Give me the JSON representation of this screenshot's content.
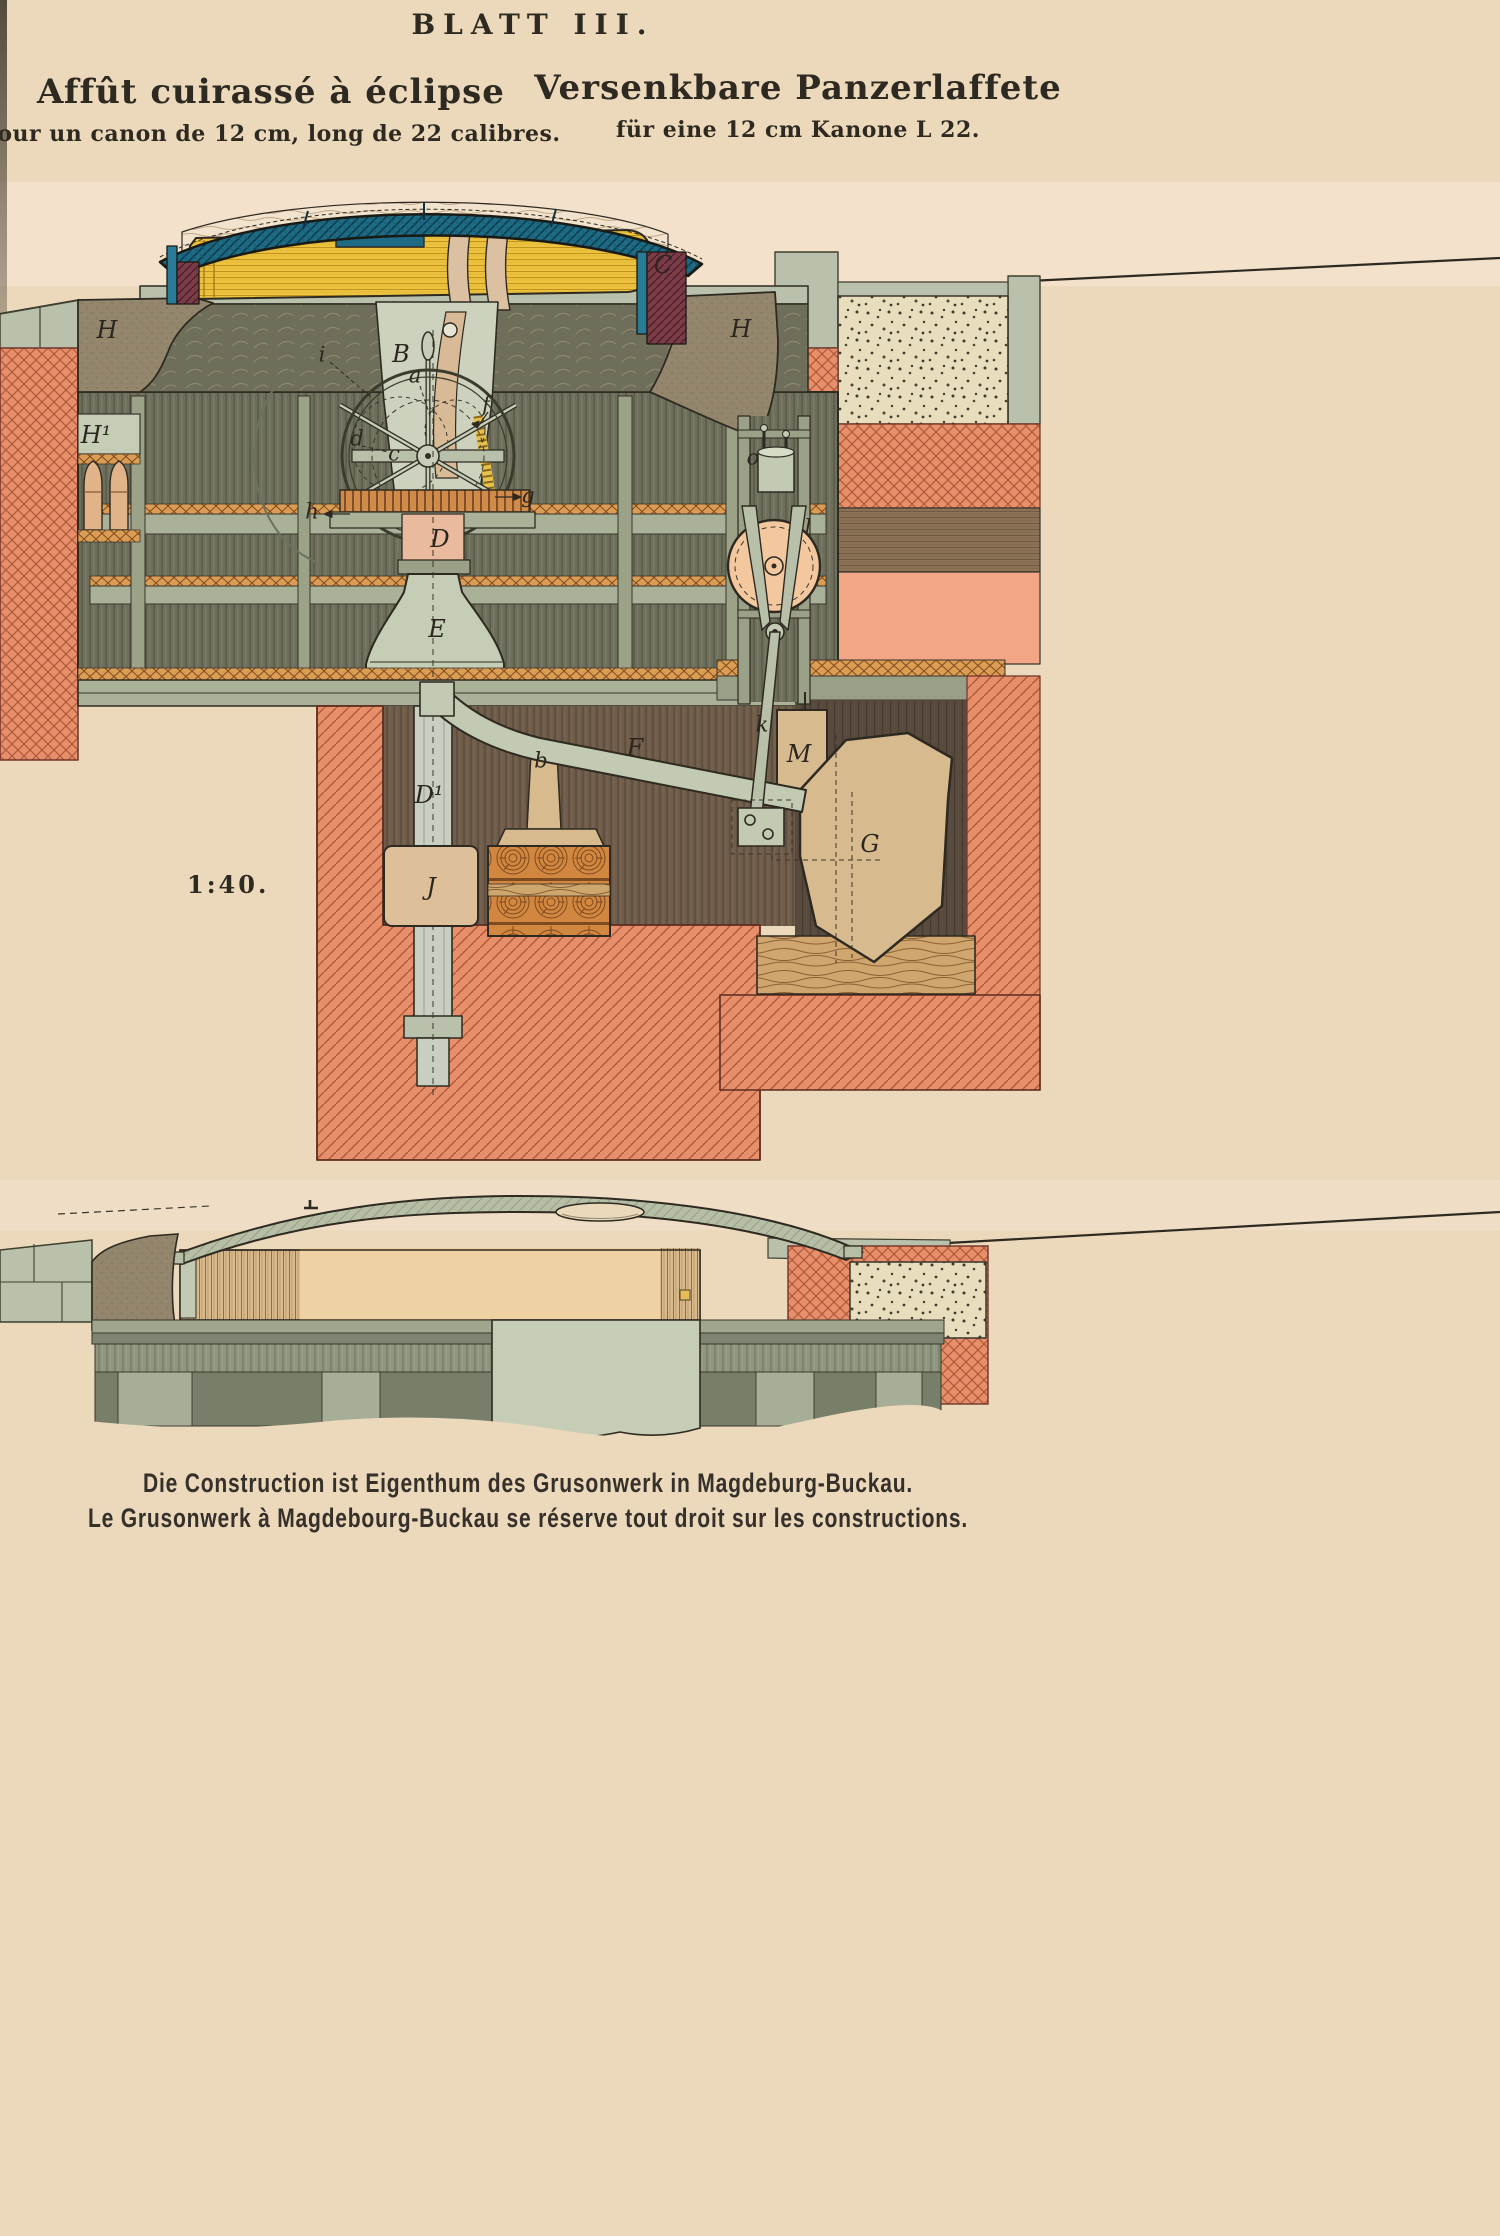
{
  "page": {
    "plate_title": "BLATT III.",
    "title_fr": "Affût cuirassé à éclipse",
    "subtitle_fr": "pour un canon de 12 cm, long de 22 calibres.",
    "title_de": "Versenkbare Panzerlaffete",
    "subtitle_de": "für eine 12 cm Kanone L 22.",
    "scale_label": "1:40.",
    "footer_de": "Die Construction ist Eigenthum des Grusonwerk in Magdeburg-Buckau.",
    "footer_fr": "Le Grusonwerk à Magdebourg-Buckau se réserve tout droit sur les constructions."
  },
  "diagram_labels": [
    {
      "text": "H",
      "x": 107,
      "y": 331,
      "kind": "cap"
    },
    {
      "text": "H¹",
      "x": 96,
      "y": 436,
      "kind": "cap"
    },
    {
      "text": "C",
      "x": 663,
      "y": 266,
      "kind": "cap"
    },
    {
      "text": "B",
      "x": 401,
      "y": 355,
      "kind": "cap"
    },
    {
      "text": "H",
      "x": 741,
      "y": 330,
      "kind": "cap"
    },
    {
      "text": "i",
      "x": 322,
      "y": 356,
      "kind": "low"
    },
    {
      "text": "a",
      "x": 415,
      "y": 377,
      "kind": "low"
    },
    {
      "text": "f",
      "x": 486,
      "y": 406,
      "kind": "low"
    },
    {
      "text": "d",
      "x": 357,
      "y": 440,
      "kind": "low"
    },
    {
      "text": "c",
      "x": 394,
      "y": 455,
      "kind": "low"
    },
    {
      "text": "g",
      "x": 528,
      "y": 497,
      "kind": "low"
    },
    {
      "text": "h",
      "x": 312,
      "y": 513,
      "kind": "low"
    },
    {
      "text": "D",
      "x": 440,
      "y": 540,
      "kind": "cap"
    },
    {
      "text": "E",
      "x": 437,
      "y": 630,
      "kind": "cap"
    },
    {
      "text": "o",
      "x": 753,
      "y": 459,
      "kind": "low"
    },
    {
      "text": "l",
      "x": 808,
      "y": 529,
      "kind": "low"
    },
    {
      "text": "k",
      "x": 762,
      "y": 726,
      "kind": "low"
    },
    {
      "text": "F",
      "x": 635,
      "y": 749,
      "kind": "cap"
    },
    {
      "text": "b",
      "x": 541,
      "y": 762,
      "kind": "low"
    },
    {
      "text": "D¹",
      "x": 429,
      "y": 796,
      "kind": "cap"
    },
    {
      "text": "M",
      "x": 799,
      "y": 755,
      "kind": "cap"
    },
    {
      "text": "G",
      "x": 870,
      "y": 845,
      "kind": "cap"
    },
    {
      "text": "J",
      "x": 431,
      "y": 888,
      "kind": "cap"
    }
  ],
  "colors": {
    "paper": "#ecd9bc",
    "paper-pink": "#f5e3d0",
    "ink": "#2e2a21",
    "teal": "#1e6b85",
    "maroon": "#7b3b47",
    "gun-yellow": "#ecc23e",
    "sage-light": "#c6cdb7",
    "sage": "#aab199",
    "sage-dark": "#8f967f",
    "olive": "#6e6f5c",
    "olive-dark": "#5f6050",
    "taupe": "#93866d",
    "salmon": "#e78e6a",
    "salmon-light": "#f2a686",
    "earth": "#6f5c4b",
    "earth-dark": "#57493d",
    "earth-light": "#8d7355",
    "tan": "#d8ba8f",
    "peach": "#f4c89e",
    "steel": "#c9cfc0"
  }
}
